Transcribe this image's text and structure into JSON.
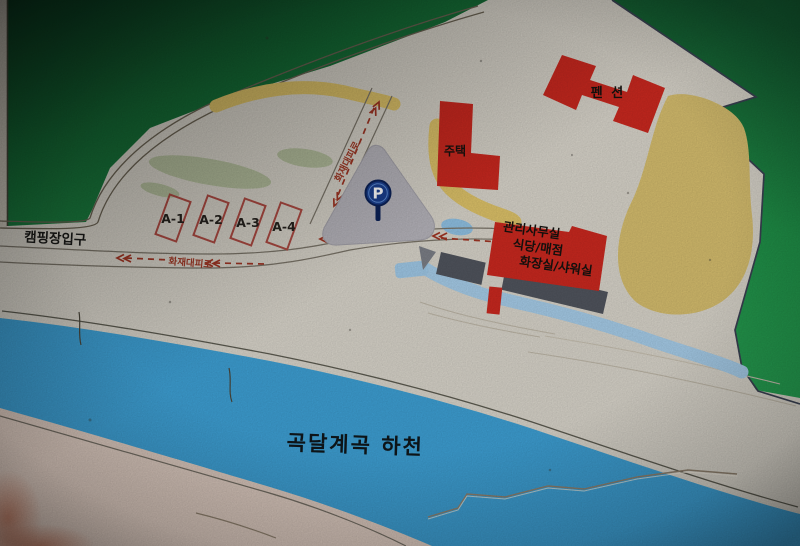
{
  "sign": {
    "kind": "campground-guide-map",
    "entrance_label": "캠핑장입구",
    "river_label": "곡달계곡 하천",
    "pension_label": "펜 션",
    "house_label": "주택",
    "office_lines": [
      "관리사무실",
      "식당/매점",
      "화장실/샤워실"
    ],
    "campsites": [
      "A-1",
      "A-2",
      "A-3",
      "A-4"
    ],
    "fire_escape_road_label": "화재대피로",
    "parking_symbol": "P",
    "colors": {
      "building_red": "#c9281f",
      "river_blue": "#3d9ed2",
      "stream_blue": "#a5cbe7",
      "sand_tan": "#d4bc6d",
      "path_yellow": "#dcc168",
      "forest_green_dark": "#0b3a20",
      "forest_green_bright": "#259a4f",
      "parking_area_gray": "#b5b3ba",
      "deck_gray": "#50545d",
      "parking_sign_blue": "#1a3f8e",
      "road_arrow_red": "#9c3c2a",
      "paper_cream": "#d7d3c9"
    }
  }
}
